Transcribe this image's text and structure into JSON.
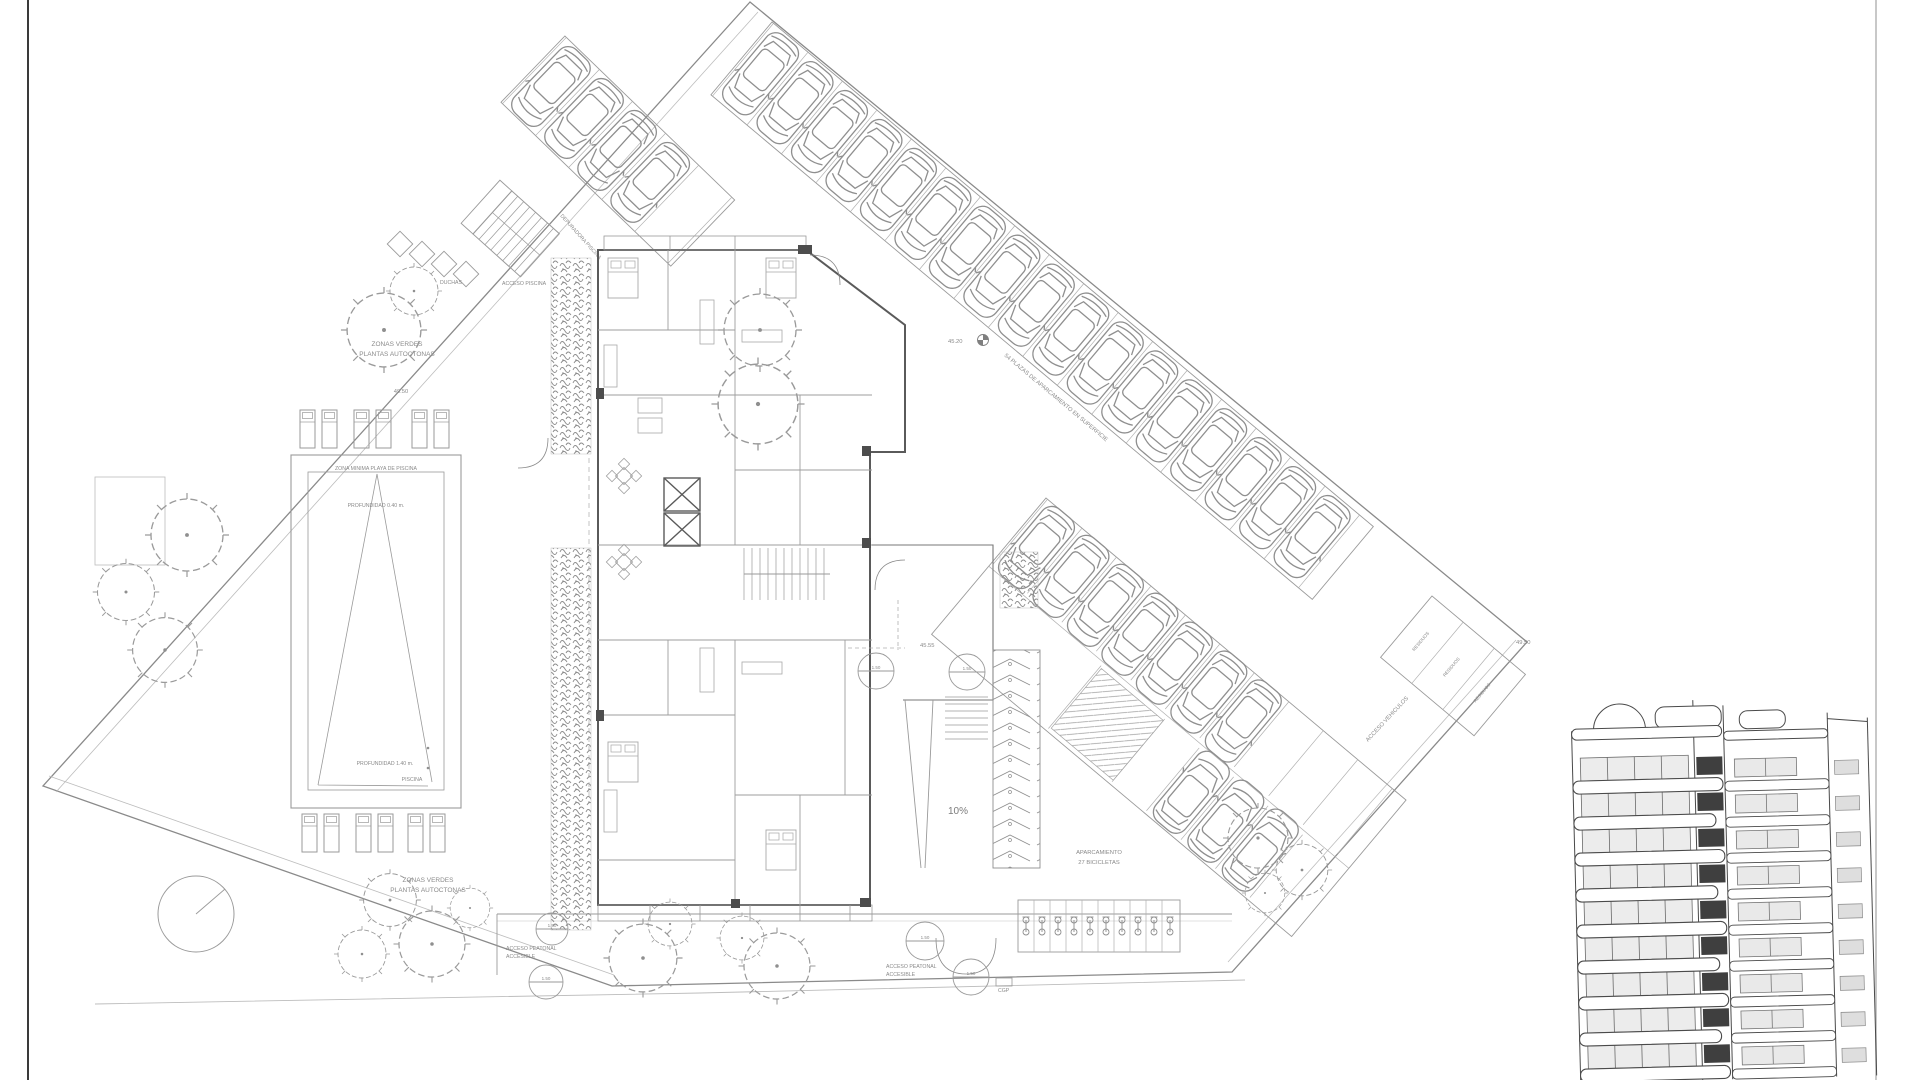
{
  "sheet": {
    "background": "#ffffff",
    "border_left_color": "#3a3a3a",
    "border_right_color": "#c8c8c8",
    "line_color": "#8a8a8a",
    "text_color": "#8a8a8a"
  },
  "labels": {
    "green_top": [
      "ZONAS VERDES",
      "PLANTAS AUTOCTONAS"
    ],
    "green_bottom": [
      "ZONAS VERDES",
      "PLANTAS AUTOCTONAS"
    ],
    "level_top": "49.50",
    "level_mid": "45.20",
    "level_terrace": "45.55",
    "level_east": "49.50",
    "pool_zone": "ZONA MINIMA PLAYA DE PISCINA",
    "pool_depth_shallow": "PROFUNDIDAD 0.40 m.",
    "pool_depth_deep": "PROFUNDIDAD 1.40 m.",
    "pool_name": "PISCINA",
    "showers": "DUCHAS",
    "pool_access": "ACCESO PISCINA",
    "pool_plant": "DEPURADORA PISCINA",
    "parking_count": "54 PLAZAS DE APARCAMIENTO EN SUPERFICIE",
    "waste": "RESIDUOS",
    "vehicle_access": "ACCESO VEHICULOS",
    "ramp_slope": "10%",
    "bike_parking": [
      "APARCAMIENTO",
      "27 BICICLETAS"
    ],
    "ped_access": [
      "ACCESO PEATONAL",
      "ACCESIBLE"
    ],
    "cgp": "CGP",
    "turning_circle": "1.50"
  }
}
